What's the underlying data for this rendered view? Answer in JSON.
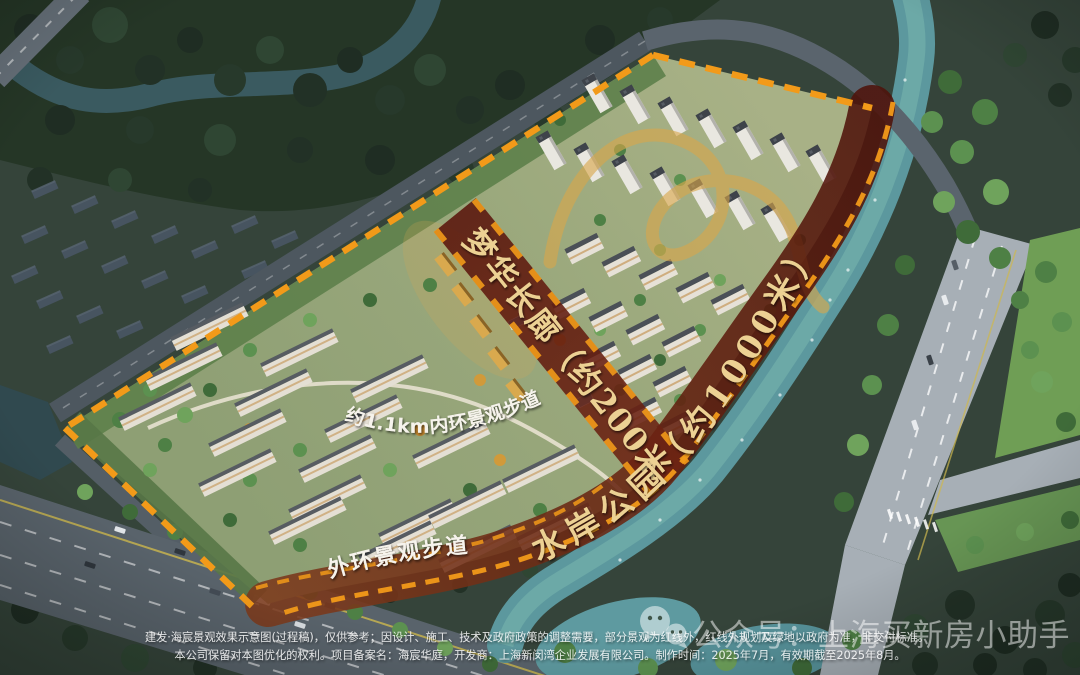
{
  "annotations": {
    "corridor": "梦华长廊（约200米）",
    "riverside_park": "水岸公园（约1000米）",
    "inner_loop": "约1.1km内环景观步道",
    "outer_loop": "外环景观步道"
  },
  "disclaimer": {
    "line1": "建发·海宸景观效果示意图(过程稿)，仅供参考；因设计、施工、技术及政府政策的调整需要，部分景观为红线外，红线外规划及绿地以政府为准，非交付标准。",
    "line2": "本公司保留对本图优化的权利。项目备案名：海宸华庭，开发商：上海新闵湾企业发展有限公司。制作时间：2025年7月，有效期截至2025年8月。"
  },
  "watermark": {
    "icon": "wechat-icon",
    "text": "公众号：上海买新房小助手"
  },
  "colors": {
    "boundary_orange": "#F29A19",
    "walkway_maroon": "#5E180D",
    "label_gold": "#ECD193",
    "river_teal": "#5F9AA0",
    "golden_ribbon": "#D8A64A"
  }
}
